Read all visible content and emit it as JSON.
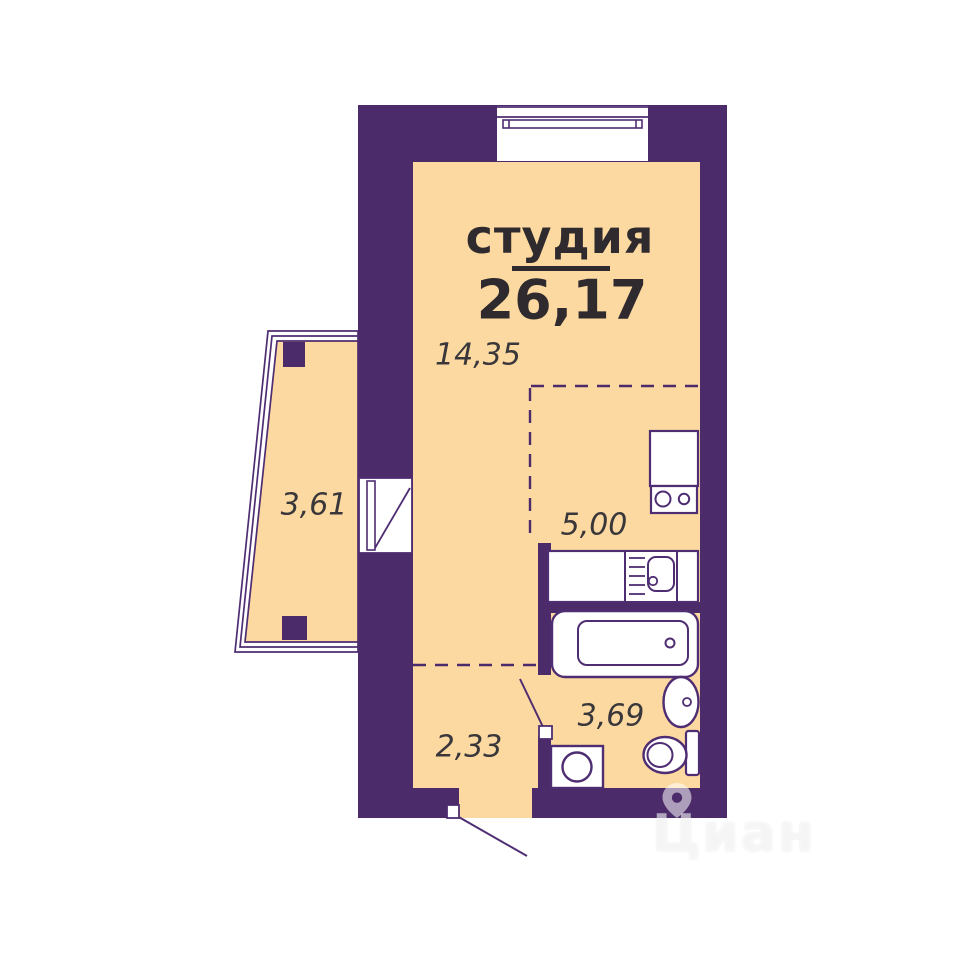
{
  "plan": {
    "type_label": "студия",
    "total_area": "26,17",
    "areas": {
      "studio": "14,35",
      "balcony": "3,61",
      "kitchen": "5,00",
      "bathroom": "3,69",
      "hallway": "2,33"
    },
    "fixtures": [
      "window",
      "balcony-door",
      "entrance-door",
      "bathroom-door",
      "kitchen-counter",
      "kitchen-sink",
      "stove",
      "bathtub",
      "washbasin",
      "toilet",
      "washing-machine"
    ],
    "colors": {
      "wall": "#4B2B69",
      "floor": "#FCD9A0",
      "fixture_outline": "#4F2D72",
      "text_dark": "#2E2A2E",
      "text_measure": "#3A373B",
      "white": "#FFFFFF"
    },
    "watermark": {
      "brand": "Циан",
      "icon": "location-pin-icon"
    }
  }
}
